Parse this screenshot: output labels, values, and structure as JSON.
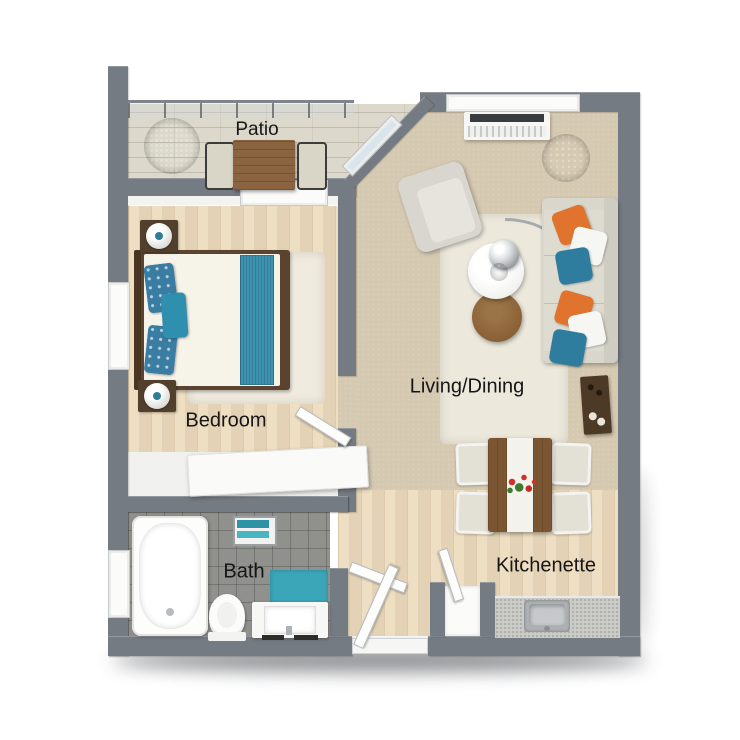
{
  "meta": {
    "type": "3d-floor-plan-render",
    "canvas": "740x740",
    "background": "#ffffff"
  },
  "rooms": {
    "patio": {
      "label": "Patio"
    },
    "bedroom": {
      "label": "Bedroom"
    },
    "living_dining": {
      "label": "Living/Dining"
    },
    "bath": {
      "label": "Bath"
    },
    "kitchenette": {
      "label": "Kitchenette"
    }
  },
  "palette": {
    "wall_gray": "#757b82",
    "carpet_beige": "#d5c9b1",
    "wood_floor": "#ecdbbc",
    "patio_stone": "#dcd8cb",
    "bath_tile": "#90908c",
    "rug_cream": "#ece8dc",
    "accent_teal": "#2e7c9e",
    "accent_orange": "#e0742e",
    "bath_mat_teal": "#3aa6b8",
    "bed_runner_teal": "#3d92b0",
    "plant_green": "#4f9e35",
    "patio_plant_green": "#6cc232",
    "dining_wood_brown": "#7c5533",
    "console_dark_wood": "#4c3a26",
    "bed_frame_brown": "#5a4430",
    "label_text": "#161616",
    "flower_red": "#d03028"
  },
  "furniture": {
    "patio": [
      "potted-plant",
      "outdoor-table",
      "outdoor-chair",
      "outdoor-chair",
      "glass-railing",
      "sliding-glass-door"
    ],
    "bedroom": [
      "double-bed",
      "headboard",
      "teal-pillows",
      "bed-runner",
      "nightstand-lamp",
      "nightstand-lamp",
      "area-rug",
      "dresser",
      "bedroom-door",
      "window"
    ],
    "living_dining": [
      "window",
      "tv-console",
      "corner-plant",
      "armchair",
      "area-rug",
      "arc-lamp",
      "coffee-table",
      "side-table",
      "sofa",
      "throw-pillows",
      "console-table",
      "dining-table",
      "table-runner",
      "flower-centerpiece",
      "dining-chair",
      "dining-chair",
      "dining-chair",
      "dining-chair"
    ],
    "bath": [
      "bathtub",
      "toilet",
      "vanity-sink",
      "bath-mat",
      "towel-rack",
      "window",
      "bath-door"
    ],
    "kitchenette": [
      "countertop",
      "kitchen-sink",
      "closet",
      "closet-door",
      "entry-door"
    ]
  }
}
